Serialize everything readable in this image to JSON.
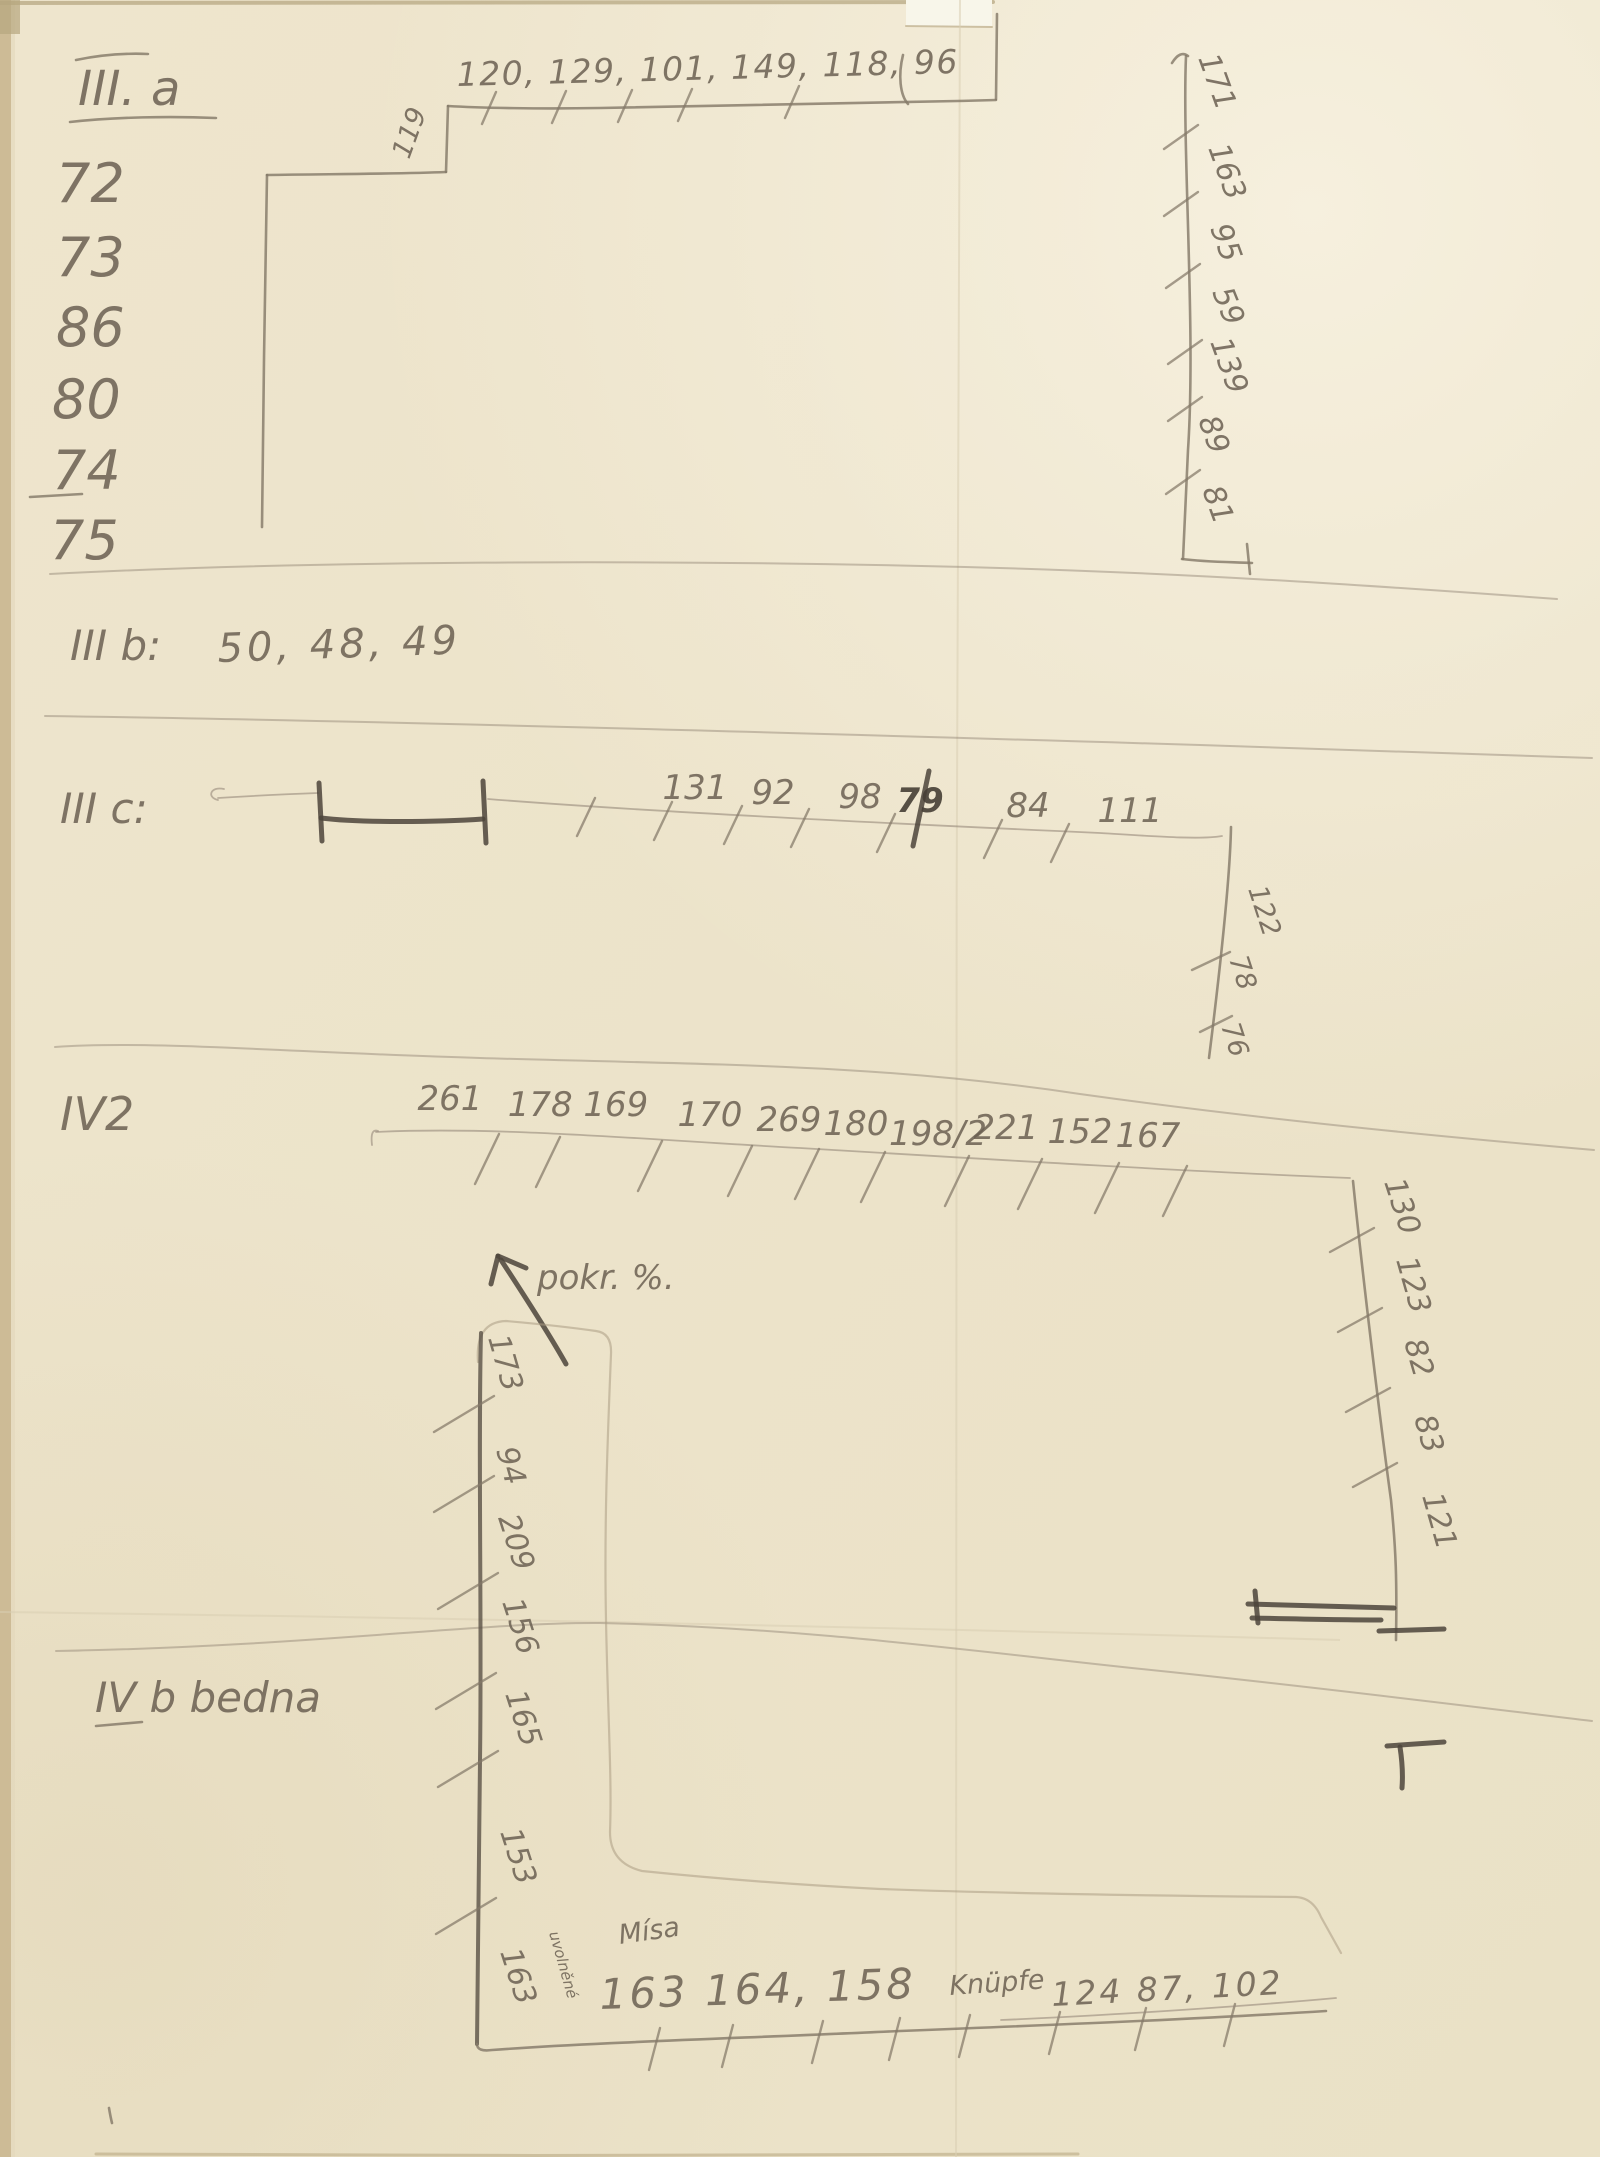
{
  "page": {
    "description": "Scanned page of handwritten pencil field notes with measurement sketches",
    "paper_color": "#ece3cb",
    "pencil_color": "#6b6052",
    "pencil_dark": "#463f36"
  },
  "section_iiia": {
    "label": "III. a",
    "left_column": [
      "72",
      "73",
      "86",
      "80",
      "74",
      "75"
    ],
    "step_value": "119",
    "top_values": "120, 129, 101, 149, 118, 96",
    "right_column": [
      "171",
      "163",
      "95",
      "59",
      "139",
      "89",
      "81"
    ]
  },
  "section_iiib": {
    "label": "III b:",
    "values": "50, 48, 49"
  },
  "section_iiic": {
    "label": "III c:",
    "row_values": [
      "131",
      "92",
      "98",
      "79",
      "84",
      "111"
    ],
    "end_column": [
      "122",
      "78",
      "76"
    ]
  },
  "section_iv2": {
    "label": "IV2",
    "row_values": [
      "261",
      "178 169",
      "170",
      "269",
      "180",
      "198/2",
      "221",
      "152",
      "167"
    ],
    "right_column": [
      "130",
      "123",
      "82",
      "83",
      "121"
    ]
  },
  "section_ivb": {
    "label": "IV b bedna",
    "arrow_note": "pokr. %.",
    "left_column": [
      "173",
      "94",
      "209",
      "156",
      "165",
      "153",
      "163"
    ],
    "side_note": "uvolněné",
    "bottom_word": "Mísa",
    "bottom_values": "163 164, 158",
    "knupfe_label": "Knüpfe",
    "knupfe_values": "124  87, 102"
  }
}
